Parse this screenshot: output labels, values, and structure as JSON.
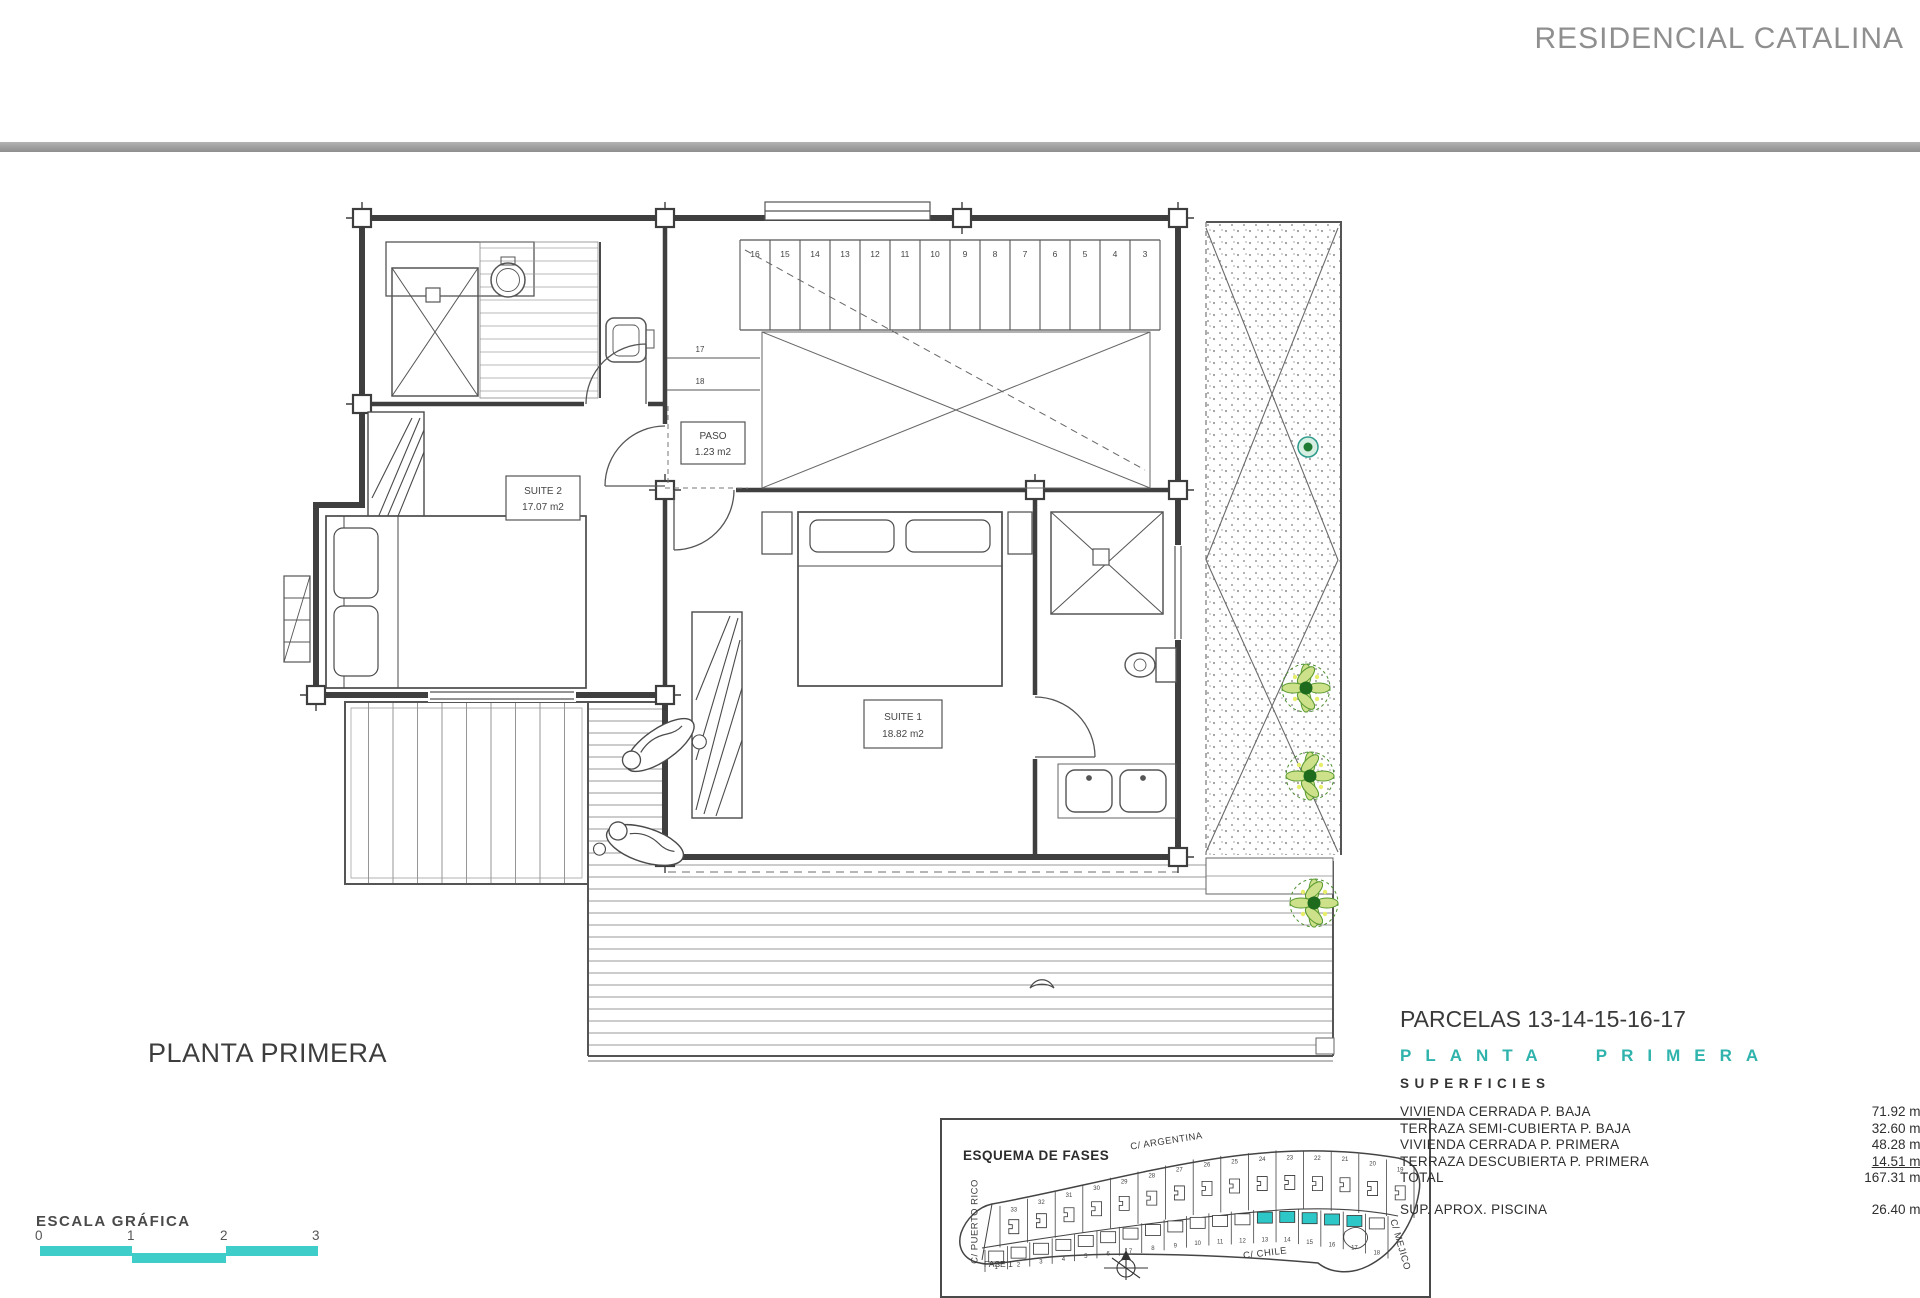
{
  "header": {
    "title": "RESIDENCIAL CATALINA"
  },
  "plan": {
    "caption": "PLANTA PRIMERA",
    "rooms": {
      "suite2": {
        "name": "SUITE 2",
        "area": "17.07 m2"
      },
      "suite1": {
        "name": "SUITE 1",
        "area": "18.82 m2"
      },
      "paso": {
        "name": "PASO",
        "area": "1.23 m2"
      }
    },
    "stairs": {
      "numbers": [
        "16",
        "15",
        "14",
        "13",
        "12",
        "11",
        "10",
        "9",
        "8",
        "7",
        "6",
        "5",
        "4",
        "3"
      ],
      "side_numbers": [
        "17",
        "18"
      ]
    }
  },
  "scale": {
    "label": "ESCALA GRÁFICA",
    "ticks": [
      "0",
      "1",
      "2",
      "3"
    ],
    "color": "#3ecdc9"
  },
  "esquema": {
    "title": "ESQUEMA DE FASES",
    "streets": {
      "top": "C/ ARGENTINA",
      "left": "C/ PUERTO RICO",
      "bottom": "C/ CHILE",
      "right": "C/ MEJICO"
    },
    "phase_label": "FASE 1",
    "upper_parcels": [
      "33",
      "32",
      "31",
      "30",
      "29",
      "28",
      "27",
      "26",
      "25",
      "24",
      "23",
      "22",
      "21",
      "20",
      "19"
    ],
    "lower_parcels": [
      "1",
      "2",
      "3",
      "4",
      "5",
      "6",
      "7",
      "8",
      "9",
      "10",
      "11",
      "12",
      "13",
      "14",
      "15",
      "16",
      "17",
      "18"
    ],
    "highlighted_parcels": [
      "13",
      "14",
      "15",
      "16",
      "17"
    ],
    "highlight_color": "#2ec7c7"
  },
  "details": {
    "parcels_title": "PARCELAS 13-14-15-16-17",
    "floor_title": "PLANTA PRIMERA",
    "floor_title_color": "#2fb3ac",
    "superficies_title": "SUPERFICIES",
    "rows": [
      {
        "label": "VIVIENDA CERRADA P. BAJA",
        "value": "71.92 m2",
        "underline": false
      },
      {
        "label": "TERRAZA SEMI-CUBIERTA P. BAJA",
        "value": "32.60 m2",
        "underline": false
      },
      {
        "label": "VIVIENDA CERRADA P. PRIMERA",
        "value": "48.28 m2",
        "underline": false
      },
      {
        "label": "TERRAZA DESCUBIERTA P. PRIMERA",
        "value": "14.51 m2",
        "underline": true
      },
      {
        "label": "TOTAL",
        "value": "167.31 m2",
        "underline": false
      }
    ],
    "extra_row": {
      "label": "SUP.  APROX.  PISCINA",
      "value": "26.40 m2"
    }
  }
}
